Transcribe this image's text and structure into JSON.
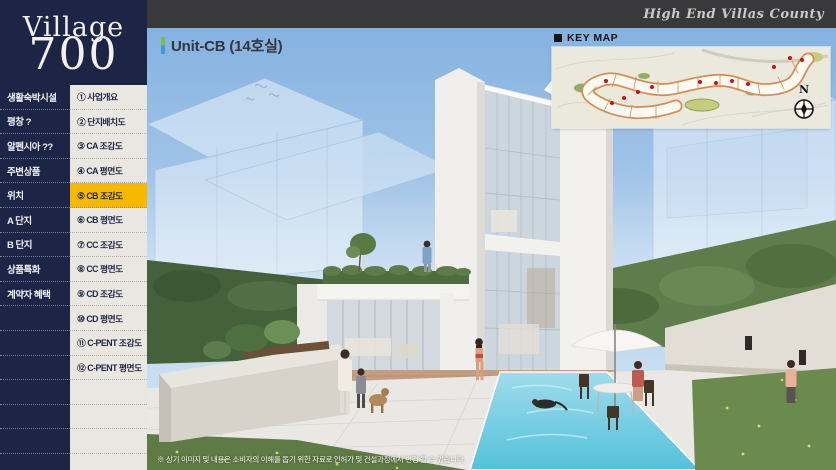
{
  "brand": {
    "line1": "Village",
    "line2": "700"
  },
  "topbar": {
    "slogan": "High End Villas County"
  },
  "sidebar": {
    "menu": [
      {
        "label": "생활숙박시설"
      },
      {
        "label": "평창 ?"
      },
      {
        "label": "알펜시아 ??"
      },
      {
        "label": "주변상품"
      },
      {
        "label": "위치"
      },
      {
        "label": "A 단지"
      },
      {
        "label": "B 단지"
      },
      {
        "label": "상품특화"
      },
      {
        "label": "계약자 혜택"
      }
    ],
    "submenu": [
      {
        "label": "① 사업개요",
        "active": false
      },
      {
        "label": "② 단지배치도",
        "active": false
      },
      {
        "label": "③ CA 조감도",
        "active": false
      },
      {
        "label": "④ CA 평면도",
        "active": false
      },
      {
        "label": "⑤ CB 조감도",
        "active": true
      },
      {
        "label": "⑥ CB 평면도",
        "active": false
      },
      {
        "label": "⑦ CC 조감도",
        "active": false
      },
      {
        "label": "⑧ CC 평면도",
        "active": false
      },
      {
        "label": "⑨ CD 조감도",
        "active": false
      },
      {
        "label": "⑩ CD 평면도",
        "active": false
      },
      {
        "label": "⑪ C-PENT 조감도",
        "active": false
      },
      {
        "label": "⑫ C-PENT 평면도",
        "active": false
      }
    ]
  },
  "main": {
    "title": "Unit-CB (14호실)",
    "keymap": {
      "label": "KEY MAP",
      "bullet_icon": "■",
      "compass_letter": "N"
    },
    "disclaimer": "※ 상기 이미지 및 내용은 소비자의 이해를 돕기 위한 자료로 인허가 및 건설과정에서 변경 될 수 있습니다."
  },
  "colors": {
    "sidebar_navy": "#1d2547",
    "submenu_cream": "#eae7e0",
    "active_yellow": "#f7b800",
    "topbar_dark": "#39393b",
    "title_accent_green": "#7dbf3e",
    "title_accent_blue": "#3e9bd5",
    "keymap_plot_orange": "#d98c52",
    "keymap_dot_red": "#cc1111",
    "pool_blue": "#6fcde2"
  }
}
